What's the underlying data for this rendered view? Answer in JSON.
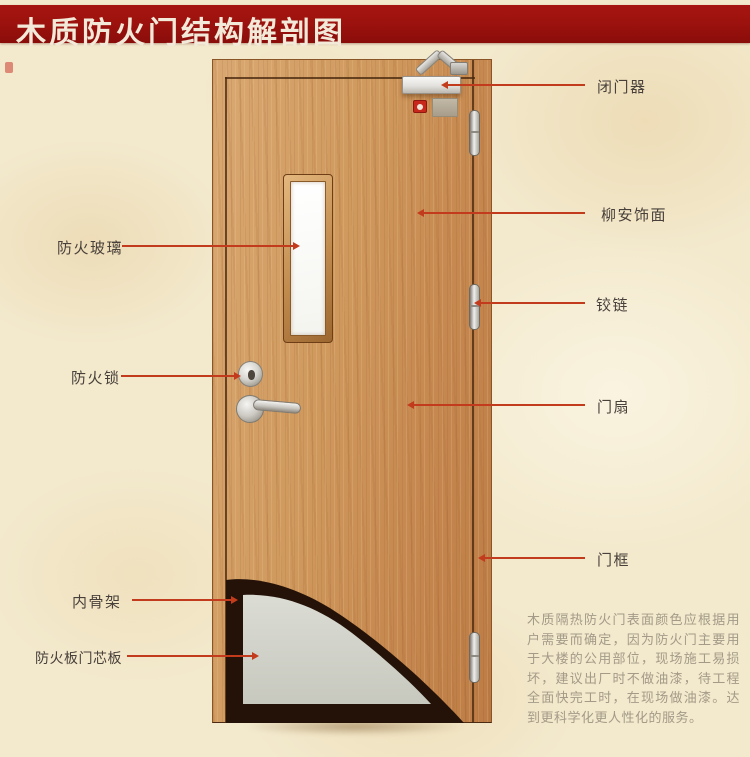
{
  "banner": {
    "title": "木质防火门结构解剖图"
  },
  "callouts": {
    "left": [
      {
        "label": "防火玻璃"
      },
      {
        "label": "防火锁"
      },
      {
        "label": "内骨架"
      },
      {
        "label": "防火板门芯板"
      }
    ],
    "right": [
      {
        "label": "闭门器"
      },
      {
        "label": "柳安饰面"
      },
      {
        "label": "铰链"
      },
      {
        "label": "门扇"
      },
      {
        "label": "门框"
      }
    ]
  },
  "description": "木质隔热防火门表面颜色应根据用户需要而确定，因为防火门主要用于大楼的公用部位，现场施工易损坏，建议出厂时不做油漆，待工程全面快完工时，在现场做油漆。达到更科学化更人性化的服务。",
  "colors": {
    "banner": "#9d120e",
    "banner_text": "#f2e9d8",
    "background": "#f3e9cd",
    "leader_line": "#c33b1d",
    "label_text": "#48403a",
    "door_wood": "#cc9256",
    "core_board": "#d2d3cb",
    "inner_skeleton": "#241208",
    "description_text": "#a39a88"
  }
}
